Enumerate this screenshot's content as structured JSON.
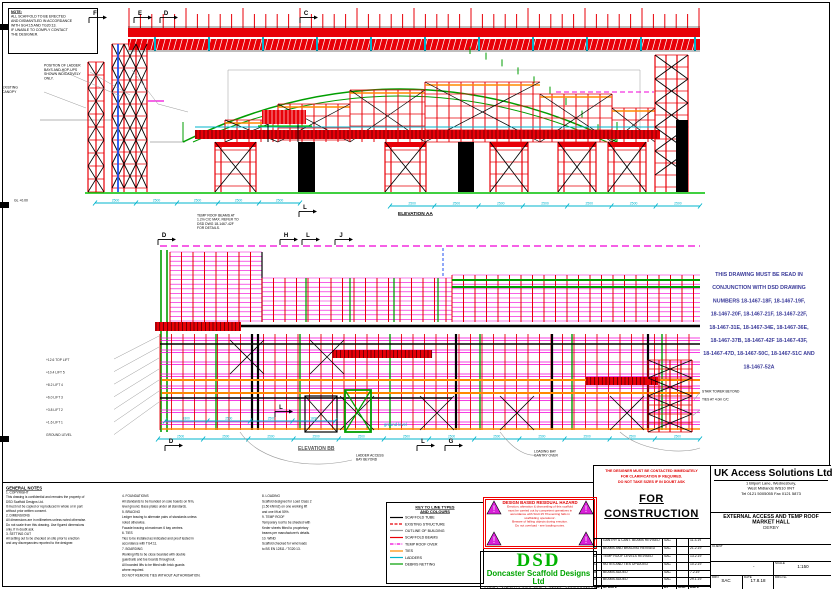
{
  "palette": {
    "red": "#e80008",
    "magenta": "#f000d8",
    "green": "#009e00",
    "bright_green": "#00c000",
    "cyan": "#00b4cd",
    "orange": "#ff8a00",
    "blue": "#2050f0",
    "note_blue": "#3b3b9a",
    "gray": "#9a9a9a",
    "black": "#000000",
    "hazard_red": "#e00000",
    "tri_magenta": "#d820d8",
    "dsd_green": "#00b400"
  },
  "top_left_note": {
    "title": "NOTE:",
    "lines": [
      "ALL SCAFFOLD TO BE ERECTED",
      "AND DISMANTLED IN ACCORDANCE",
      "WITH SG4:15 AND TG20:13.",
      "IF UNABLE TO COMPLY CONTACT",
      "THE DESIGNER."
    ]
  },
  "sub_note": {
    "lines": [
      "POSITION OF LADDER",
      "BAYS AND HOP-UPS",
      "SHOWN INDICATIVELY",
      "ONLY."
    ]
  },
  "canopy_label": {
    "lines": [
      "EXISTING",
      "CANOPY"
    ]
  },
  "gl_label": "GL +0.00",
  "mid_note": {
    "lines": [
      "TEMP ROOF BEAMS AT",
      "1.2m C/C MAX. REFER TO",
      "DSD DWG 18-1467-42F",
      "FOR DETAILS."
    ]
  },
  "top_elevation": {
    "title": "ELEVATION AA",
    "markers": [
      {
        "letter": "F",
        "x": 92
      },
      {
        "letter": "E",
        "x": 137
      },
      {
        "letter": "D",
        "x": 163
      },
      {
        "letter": "C",
        "x": 303
      }
    ],
    "markers_below": [
      {
        "letter": "L",
        "x": 302,
        "y": 206
      }
    ],
    "dims1": [
      "2500",
      "2500",
      "2500",
      "2500",
      "2500"
    ],
    "dims2": [
      "2500",
      "2500",
      "2500",
      "2500",
      "2500",
      "2500",
      "2500"
    ]
  },
  "bottom_elevation": {
    "title": "ELEVATION BB",
    "markers_top": [
      {
        "letter": "D",
        "x": 161
      },
      {
        "letter": "H",
        "x": 283
      },
      {
        "letter": "L",
        "x": 305
      },
      {
        "letter": "J",
        "x": 338
      }
    ],
    "markers_mid": [
      {
        "letter": "L",
        "x": 278,
        "y": 406
      }
    ],
    "markers_bottom": [
      {
        "letter": "D",
        "x": 168
      },
      {
        "letter": "L",
        "x": 420
      },
      {
        "letter": "G",
        "x": 448
      }
    ],
    "dims": [
      "2500",
      "2500",
      "2500",
      "2500",
      "2500",
      "2500",
      "2500",
      "2500",
      "2500",
      "2500",
      "2500",
      "2500"
    ],
    "dims2": [
      "1800",
      "2500",
      "2500",
      "1800"
    ],
    "ground_label": "ground level"
  },
  "left_levels": [
    "+12.6 TOP LIFT",
    "+10.4 LIFT 5",
    "+8.2 LIFT 4",
    "+6.0 LIFT 3",
    "+3.8 LIFT 2",
    "+1.6 LIFT 1",
    "GROUND LEVEL"
  ],
  "right_labels": [
    "STAIR TOWER BEYOND",
    "TIES AT 4.0m C/C"
  ],
  "below_label_1": {
    "lines": [
      "LADDER ACCESS",
      "BAY BEYOND"
    ]
  },
  "below_label_2": {
    "lines": [
      "LOADING BAY",
      "GANTRY OVER"
    ]
  },
  "conjunction_note": {
    "lines": [
      "THIS DRAWING MUST BE READ IN",
      "CONJUNCTION WITH DSD DRAWING",
      "NUMBERS 18-1467-18F, 18-1467-19F,",
      "18-1467-20F, 18-1467-21F, 18-1467-22F,",
      "18-1467-31E, 18-1467-34E, 18-1467-36E,",
      "18-1467-37B, 18-1467-42F 18-1467-43F,",
      "18-1467-47D, 18-1467-50C, 18-1467-51C AND",
      "18-1467-52A"
    ]
  },
  "general_notes": {
    "title": "GENERAL NOTES",
    "lines": [
      "1.  COPYRIGHT",
      "    This drawing is confidential and remains the property of",
      "    DSD Scaffold Designs Ltd.",
      "    It must not be copied or reproduced in whole or in part",
      "    without prior written consent.",
      "2.  DIMENSIONS",
      "    All dimensions are in millimetres unless noted otherwise.",
      "    Do not scale from this drawing. Use figured dimensions",
      "    only. If in doubt ask.",
      "3.  SETTING OUT",
      "    All setting out to be checked on site prior to erection",
      "    and any discrepancies reported to the designer."
    ]
  },
  "notes_col1": {
    "lines": [
      "4.  FOUNDATIONS",
      "    All standards to be founded on sole boards on firm,",
      "    level ground. Base plates under all standards.",
      "5.  BRACING",
      "    Ledger bracing to alternate pairs of standards unless",
      "    noted otherwise.",
      "    Facade bracing at maximum 6 bay centres.",
      "6.  TIES",
      "    Ties to be installed as indicated and proof tested in",
      "    accordance with TG4:11.",
      "7.  BOARDING",
      "    Working lifts to be close boarded with double",
      "    guardrails and toe boards throughout.",
      "    All boarded lifts to be fitted with brick guards",
      "    where required.",
      "    DO NOT REMOVE TIES WITHOUT AUTHORISATION."
    ]
  },
  "notes_col2": {
    "lines": [
      "8.  LOADING",
      "    Scaffold designed for Load Class 2",
      "    (1.50 kN/m2) on one working lift",
      "    and one lift at 50%.",
      "9.  TEMP ROOF",
      "    Temporary roof to be sheeted with",
      "    Keder sheets fitted to proprietary",
      "    beams per manufacturer's details.",
      "10. WIND",
      "    Scaffold checked for wind loads",
      "    to BS EN 12811 / TG20:13."
    ]
  },
  "legend": {
    "title1": "KEY TO LINE TYPES",
    "title2": "AND COLOURS",
    "items": [
      {
        "label": "SCAFFOLD TUBE",
        "color": "#000000",
        "style": "solid"
      },
      {
        "label": "EXISTING STRUCTURE",
        "color": "#e80008",
        "style": "dashed"
      },
      {
        "label": "OUTLINE OF BUILDING",
        "color": "#9a9a9a",
        "style": "solid"
      },
      {
        "label": "SCAFFOLD BEAMS",
        "color": "#e80008",
        "style": "solid"
      },
      {
        "label": "TEMP ROOF OVER",
        "color": "#f000d8",
        "style": "dashdot"
      },
      {
        "label": "TIES",
        "color": "#ff8a00",
        "style": "solid"
      },
      {
        "label": "LADDERS",
        "color": "#00b4cd",
        "style": "solid"
      },
      {
        "label": "DEBRIS NETTING",
        "color": "#009e00",
        "style": "solid"
      }
    ]
  },
  "hazard": {
    "title": "DESIGN BASED RESIDUAL HAZARD",
    "lines": [
      "Erection, alteration & dismantling of this scaffold",
      "must be carried out by competent operatives in",
      "accordance with SG4:15 'Preventing falls in",
      "scaffolding operations'.",
      "Beware of falling objects during erection.",
      "Do not overload - see loading notes."
    ]
  },
  "designer_note": {
    "lines": [
      "THE DESIGNER MUST BE CONTACTED IMMEDIATELY",
      "FOR CLARIFICATION IF REQUIRED.",
      "DO NOT TAKE SIZES      IF IN DOUBT ASK"
    ]
  },
  "for_construction": {
    "line1": "FOR",
    "line2": "CONSTRUCTION"
  },
  "revisions": {
    "header": [
      "NO.",
      "UPDATE",
      "BY",
      "CHK",
      "DATE"
    ],
    "rows": [
      {
        "rev": "F",
        "desc": "GANTRY & CANT. BEAMS REVISED",
        "by": "SAC",
        "chk": "",
        "date": "11.3.19"
      },
      {
        "rev": "E",
        "desc": "BEAMS AND BRACING REVISED",
        "by": "SAC",
        "chk": "",
        "date": "21.2.19"
      },
      {
        "rev": "D",
        "desc": "TEMP ROOF LEVELS REVISED",
        "by": "SAC",
        "chk": "",
        "date": "13.2.19"
      },
      {
        "rev": "C",
        "desc": "NOTES AND TIES UPDATED",
        "by": "SAC",
        "chk": "",
        "date": "10.2.19"
      },
      {
        "rev": "B",
        "desc": "BEAMS ADDED",
        "by": "SAC",
        "chk": "",
        "date": "7.2.19"
      },
      {
        "rev": "A",
        "desc": "BEAMS ADDED",
        "by": "SAC",
        "chk": "",
        "date": "29.1.19"
      }
    ]
  },
  "dsd": {
    "name": "DSD",
    "company": "Doncaster Scaffold Designs Ltd",
    "line1": "Unit 5 Shaw Lane Ind. Estate, Doncaster DN2 4SE",
    "line2": "Tel: 01302 530771   e: designs@dsd-scaffold.co.uk"
  },
  "title_block": {
    "company": "UK Access Solutions Ltd",
    "address1": "1 Bilport Lane, Wednesbury,",
    "address2": "West Midlands WS10 0NT",
    "address3": "Tel 0121 5005055  Fax 0121 5873",
    "project1": "EXTERNAL ACCESS AND TEMP ROOF",
    "project2": "MARKET HALL",
    "project3": "DERBY",
    "client_label": "CLIENT",
    "client_value": "",
    "blank_value": "-",
    "scale_label": "SCALE",
    "scale_value": "1:150",
    "drn_label": "DRN",
    "drn_value": "SAC",
    "date_label": "DATE",
    "date_value": "17.8.18",
    "drg_label": "DRG No.",
    "drg_no": "DSD 18-1467-21F",
    "chk_label": "CHK",
    "app_label": "APP"
  }
}
